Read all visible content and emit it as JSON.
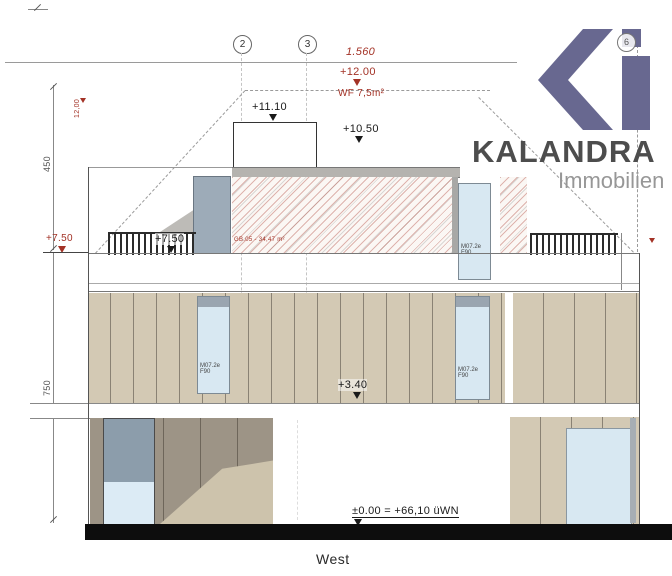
{
  "title": {
    "view_label": "West"
  },
  "logo": {
    "brand": "KALANDRA",
    "subtitle": "Immobilien"
  },
  "grid": {
    "bubble_2": "2",
    "bubble_3": "3",
    "bubble_6": "6"
  },
  "dimensions": {
    "top_width_red": "1.560",
    "upper_height": "450",
    "lower_height": "750",
    "ridge_left_red": "12,00",
    "ridge_right_red": "12,00"
  },
  "levels": {
    "ridge_red": "+12.00",
    "roof_area_red": "WF 7,5m²",
    "stair_overrun": "+11.10",
    "roof": "+10.50",
    "terrace_red": "+7.50",
    "terrace_black": "+7.50",
    "floor1": "+3.40",
    "ground": "±0.00 = +66,10 üWN"
  },
  "labels": {
    "terrace_area_red": "GB.05 - 34,47 m²",
    "window_tag_line1": "M07.2e",
    "window_tag_line2": "F90"
  },
  "colors": {
    "annotation_red": "#a33226",
    "logo_slate": "#686890",
    "brand_gray": "#4d4d4d",
    "subtitle_gray": "#979797",
    "cladding_light": "#d3c9b4",
    "cladding_dark": "#9d9486",
    "glass_blue": "#d8e8f2",
    "ground_black": "#0d0d0d"
  }
}
